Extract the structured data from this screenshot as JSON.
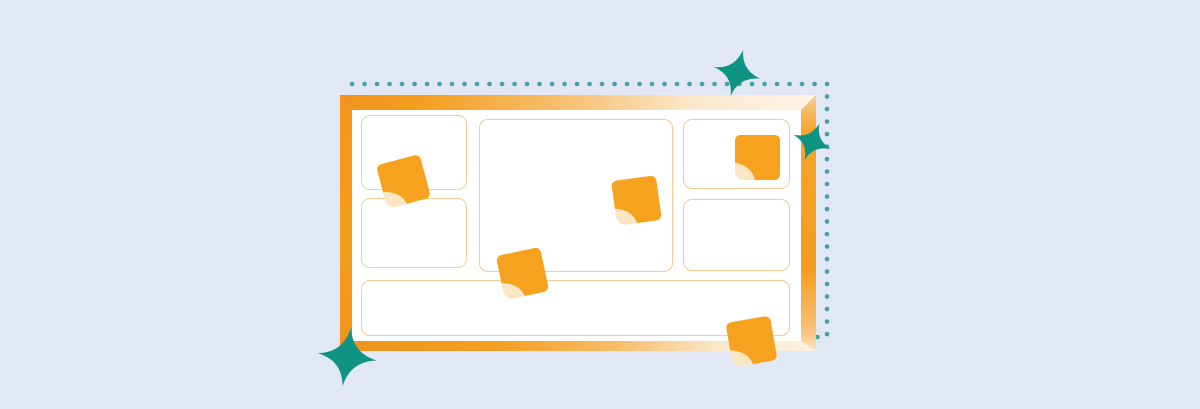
{
  "illustration": {
    "name": "whiteboard-with-sticky-notes",
    "colors": {
      "background": "#E2E8F3",
      "frame_orange": "#F49D1E",
      "frame_orange_deep": "#F0941C",
      "frame_cream": "#FBE8CB",
      "board_surface": "#FFFFFF",
      "panel_border": "#F7C994",
      "note_orange": "#F6A21E",
      "note_fold_cream": "#FAE6C2",
      "sparkle_teal": "#0E9384",
      "dot_teal": "#45A1A3"
    },
    "dotted_border": {
      "path": "M352 84 H827 V337 H812",
      "dot_diameter": 4.6,
      "dot_spacing": 12.4
    },
    "board": {
      "panels": [
        {
          "id": "panel-top-left",
          "x": 9,
          "y": 5,
          "w": 106,
          "h": 75
        },
        {
          "id": "panel-bottom-left",
          "x": 9,
          "y": 88,
          "w": 106,
          "h": 70
        },
        {
          "id": "panel-center",
          "x": 127,
          "y": 9,
          "w": 194,
          "h": 153
        },
        {
          "id": "panel-top-right",
          "x": 331,
          "y": 9,
          "w": 107,
          "h": 70
        },
        {
          "id": "panel-bottom-right",
          "x": 331,
          "y": 89,
          "w": 107,
          "h": 72
        },
        {
          "id": "panel-bottom-wide",
          "x": 9,
          "y": 170,
          "w": 429,
          "h": 56
        }
      ]
    },
    "sticky_notes": [
      {
        "x": 381,
        "y": 159,
        "rotation": -15
      },
      {
        "x": 614,
        "y": 178,
        "rotation": -8
      },
      {
        "x": 735,
        "y": 135,
        "rotation": 0
      },
      {
        "x": 500,
        "y": 251,
        "rotation": -12
      },
      {
        "x": 729,
        "y": 319,
        "rotation": -10
      }
    ],
    "sparkles": [
      {
        "x": 712,
        "y": 48,
        "size": 50,
        "rotation": 15
      },
      {
        "x": 791,
        "y": 121,
        "size": 42,
        "rotation": 22
      },
      {
        "x": 316,
        "y": 326,
        "size": 62,
        "rotation": 8
      }
    ]
  }
}
